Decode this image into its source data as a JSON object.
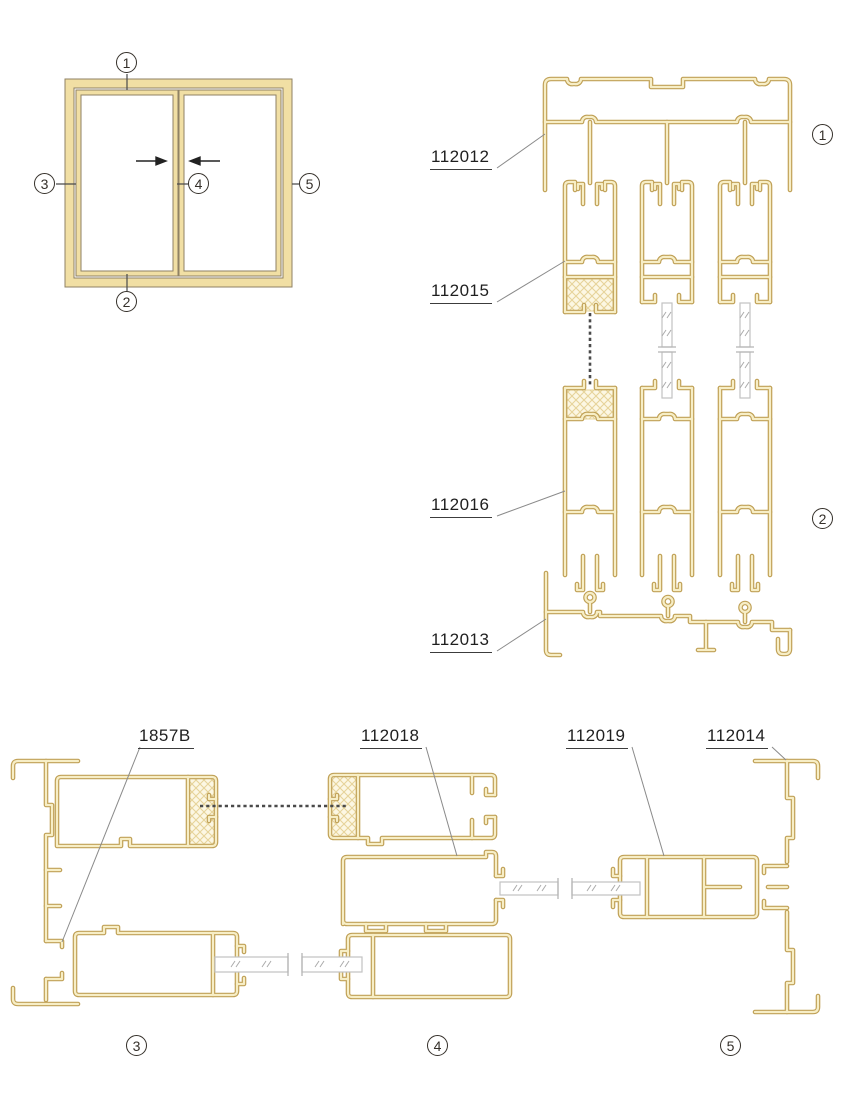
{
  "page": {
    "background": "#ffffff"
  },
  "palette": {
    "aluminum_edge": "#c0a157",
    "aluminum_core": "#f7eec6",
    "aluminum_fill": "#f1dfa4",
    "frame_outline": "#8f8264",
    "glass_line": "#c2c2c2",
    "glass_mark": "#ababab",
    "hatch_line": "#e6d399",
    "brush_seal": "#4a4a4a",
    "leader": "#8a8a8a",
    "text_color": "#1f1f1f"
  },
  "elevation": {
    "markers": [
      {
        "n": "1"
      },
      {
        "n": "2"
      },
      {
        "n": "3"
      },
      {
        "n": "4"
      },
      {
        "n": "5"
      }
    ],
    "slide_direction": "both panels slide toward center"
  },
  "sections": {
    "markers": [
      {
        "n": "1"
      },
      {
        "n": "2"
      },
      {
        "n": "3"
      },
      {
        "n": "4"
      },
      {
        "n": "5"
      }
    ]
  },
  "parts": {
    "head_frame": "112012",
    "top_sash": "112015",
    "bottom_sash": "112016",
    "sill_frame": "112013",
    "bracket": "1857B",
    "interlock_sash": "112018",
    "side_sash": "112019",
    "side_jamb": "112014"
  }
}
